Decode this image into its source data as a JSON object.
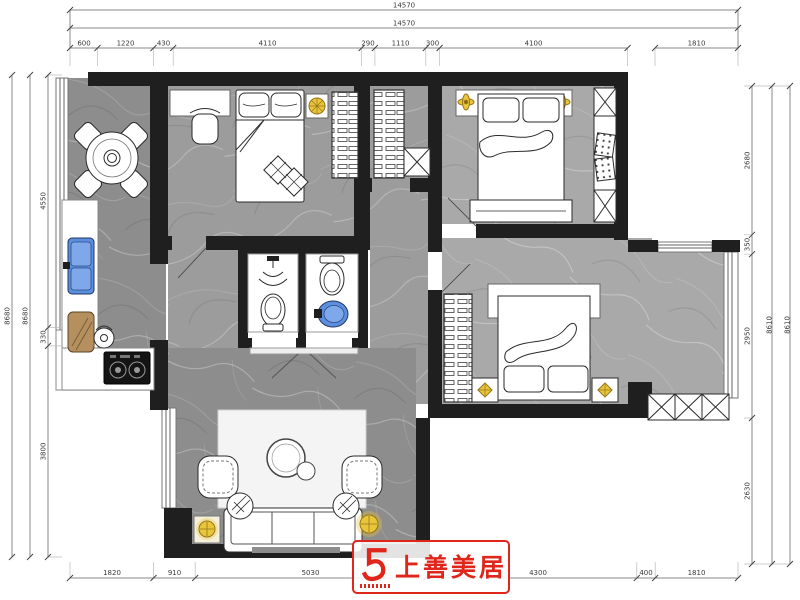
{
  "logo": {
    "text": "上善美居"
  },
  "dimensions": {
    "top": {
      "total_outer": "14570",
      "total_inner": "14570",
      "segments": [
        "600",
        "1220",
        "430",
        "4110",
        "290",
        "1110",
        "300",
        "4100",
        "1810"
      ]
    },
    "bottom": {
      "segments": [
        "1820",
        "910",
        "5030",
        "300",
        "4300",
        "400",
        "1810"
      ]
    },
    "left": {
      "total_outer": "8680",
      "total_inner": "8680",
      "segments": [
        "4550",
        "330",
        "3800"
      ]
    },
    "right": {
      "total_outer": "8610",
      "total_inner": "8610",
      "segments": [
        "2680",
        "350",
        "2950",
        "2630"
      ]
    }
  },
  "colors": {
    "wall": "#1f1f1f",
    "accent_red": "#e0251b",
    "lamp_yellow": "#e9c53a",
    "sink_blue": "#5b8ede",
    "board_brown": "#b5905e"
  }
}
